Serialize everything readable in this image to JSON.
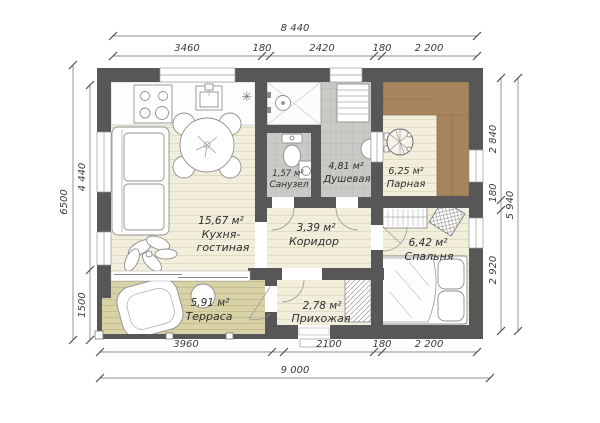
{
  "rooms": {
    "kitchen_living": {
      "area": "15,67 м²",
      "name1": "Кухня-",
      "name2": "гостиная"
    },
    "bathroom": {
      "area": "1,57 м²",
      "name": "Санузел"
    },
    "shower": {
      "area": "4,81 м²",
      "name": "Душевая"
    },
    "steam": {
      "area": "6,25 м²",
      "name": "Парная"
    },
    "corridor": {
      "area": "3,39 м²",
      "name": "Коридор"
    },
    "bedroom": {
      "area": "6,42 м²",
      "name": "Спальня"
    },
    "terrace": {
      "area": "5,91 м²",
      "name": "Терраса"
    },
    "hallway": {
      "area": "2,78 м²",
      "name": "Прихожая"
    }
  },
  "dims": {
    "top_total": "8 440",
    "top": [
      "3460",
      "180",
      "2420",
      "180",
      "2 200"
    ],
    "bottom": [
      "3960",
      "2100",
      "180",
      "2 200"
    ],
    "bottom_total": "9 000",
    "left_total": "6500",
    "left": [
      "4 440",
      "1500"
    ],
    "right": [
      "2 840",
      "180",
      "2 920"
    ],
    "right_total": "5 940"
  },
  "symbols": {
    "kitchen_star": "✳"
  },
  "colors": {
    "wall": "#575757",
    "floor_wood": "#f1eedb",
    "deck": "#d9d2a6",
    "tile": "#cbcac6",
    "bench": "#a6855d"
  }
}
